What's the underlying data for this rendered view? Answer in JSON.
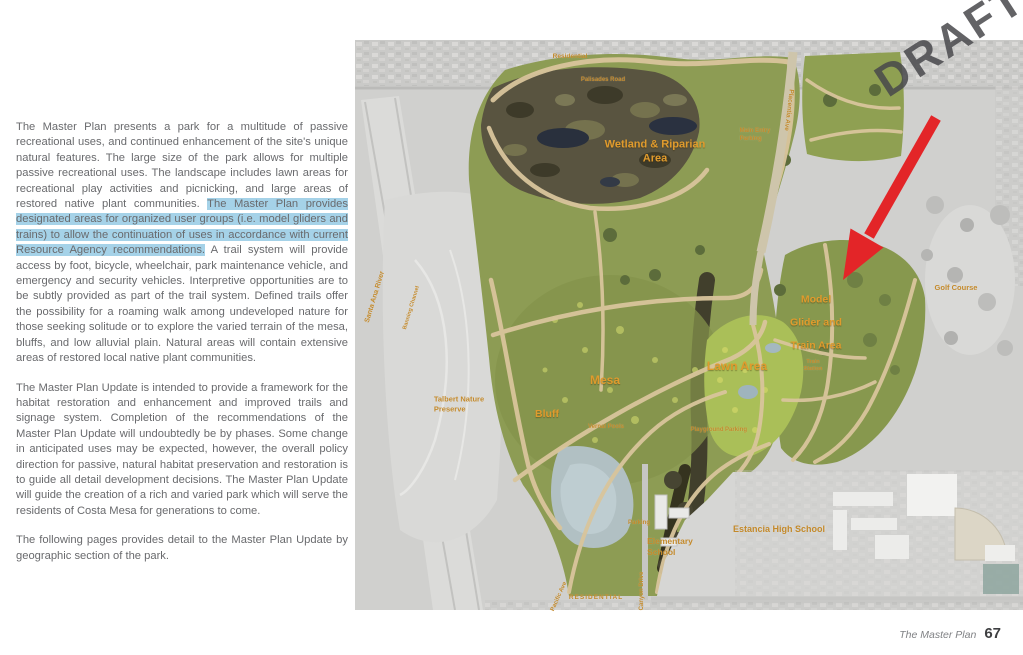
{
  "watermark": "DRAFT",
  "footer": {
    "section": "The Master Plan",
    "page": "67"
  },
  "article": {
    "p1_before": "The Master Plan presents a park for a multitude of passive recreational uses, and continued enhancement of the site's unique natural features. The large size of the park allows for multiple passive recreational uses. The landscape includes lawn areas for recreational play activities and picnicking, and large areas of restored native plant communities. ",
    "p1_highlight": "The Master Plan provides designated areas for organized user groups (i.e. model gliders and trains) to allow the continuation of uses in accordance with current Resource Agency recommendations.",
    "p1_after": " A trail system will provide access by foot, bicycle, wheelchair, park maintenance vehicle, and emergency and security vehicles. Interpretive opportunities are to be subtly provided as part of the trail system. Defined trails offer the possibility for a roaming walk among undeveloped nature for those seeking solitude or to explore the varied terrain of the mesa, bluffs, and low alluvial plain. Natural areas will contain extensive areas of restored local native plant communities.",
    "p2": "The Master Plan Update is intended to provide a framework for the habitat restoration and enhancement and improved trails and signage system. Completion of the recommendations of the Master Plan Update will undoubtedly be by phases. Some change in anticipated uses may be expected, however, the overall policy direction for passive, natural habitat preservation and restoration is to guide all detail development decisions. The Master Plan Update will guide the creation of a rich and varied park which will serve the residents of Costa Mesa for generations to come.",
    "p3": "The following pages provides detail to the Master Plan Update by geographic section of the park."
  },
  "map": {
    "colors": {
      "label_orange": "#e09b2d",
      "label_gold": "#c3892a",
      "highlight_blue": "#a5d2e8",
      "arrow_red": "#e32528",
      "park_green": "#8d9c54",
      "wetland_dark": "#595440"
    },
    "labels": [
      {
        "id": "residential-north",
        "text": "Residential",
        "x": 215,
        "y": 17,
        "size": 6.5,
        "rot": 0,
        "cls": "gold"
      },
      {
        "id": "palisades-road",
        "text": "Palisades Road",
        "x": 248,
        "y": 41,
        "size": 6,
        "rot": 0,
        "cls": "gold"
      },
      {
        "id": "placentia-ave",
        "text": "Placentia Ave",
        "x": 433,
        "y": 70,
        "size": 6.5,
        "rot": 97,
        "cls": "gold"
      },
      {
        "id": "main-entry-parking",
        "text": "Main Entry\nParking",
        "x": 400,
        "y": 96,
        "size": 6,
        "rot": 0,
        "cls": "gold",
        "align": "left"
      },
      {
        "id": "wetland-riparian-area",
        "text": "Wetland & Riparian\nArea",
        "x": 300,
        "y": 112,
        "size": 11,
        "rot": 0,
        "cls": "orange",
        "weight": 700
      },
      {
        "id": "santa-ana-river",
        "text": "Santa Ana River",
        "x": 20,
        "y": 257,
        "size": 7,
        "rot": -73,
        "cls": "gold",
        "weight": 700
      },
      {
        "id": "banning-channel",
        "text": "Banning Channel",
        "x": 57,
        "y": 268,
        "size": 5.5,
        "rot": -73,
        "cls": "gold"
      },
      {
        "id": "golf-course",
        "text": "Golf Course",
        "x": 601,
        "y": 248,
        "size": 7.5,
        "rot": 0,
        "cls": "gold",
        "weight": 700
      },
      {
        "id": "talbert-nature-preserve",
        "text": "Talbert Nature\nPreserve",
        "x": 104,
        "y": 364,
        "size": 7.5,
        "rot": 0,
        "cls": "gold",
        "weight": 700,
        "align": "left"
      },
      {
        "id": "bluff",
        "text": "Bluff",
        "x": 192,
        "y": 375,
        "size": 10.5,
        "rot": 0,
        "cls": "orange",
        "weight": 700
      },
      {
        "id": "mesa",
        "text": "Mesa",
        "x": 250,
        "y": 341,
        "size": 12,
        "rot": 0,
        "cls": "orange",
        "weight": 700
      },
      {
        "id": "lawn-area",
        "text": "Lawn Area",
        "x": 382,
        "y": 327,
        "size": 12,
        "rot": 0,
        "cls": "orange",
        "weight": 700
      },
      {
        "id": "vernal-pools",
        "text": "Vernal Pools",
        "x": 251,
        "y": 388,
        "size": 6,
        "rot": 0,
        "cls": "gold",
        "weight": 700
      },
      {
        "id": "playground",
        "text": "Playground",
        "x": 352,
        "y": 391,
        "size": 6,
        "rot": 0,
        "cls": "gold"
      },
      {
        "id": "parking-lawn",
        "text": "Parking",
        "x": 381,
        "y": 391,
        "size": 6,
        "rot": 0,
        "cls": "gold"
      },
      {
        "id": "model-glider-train-area",
        "text": "Model\nGlider and\nTrain Area",
        "x": 461,
        "y": 283,
        "size": 10.5,
        "rot": 0,
        "cls": "orange",
        "weight": 700,
        "lh": 2.2
      },
      {
        "id": "train-station",
        "text": "Train\nStation",
        "x": 458,
        "y": 326,
        "size": 5.5,
        "rot": 0,
        "cls": "gold"
      },
      {
        "id": "parking-south",
        "text": "Parking",
        "x": 284,
        "y": 484,
        "size": 6,
        "rot": 0,
        "cls": "gold"
      },
      {
        "id": "elementary-school",
        "text": "Elementary\nSchool",
        "x": 315,
        "y": 507,
        "size": 8.5,
        "rot": 0,
        "cls": "gold",
        "weight": 700,
        "align": "left"
      },
      {
        "id": "estancia-high-school",
        "text": "Estancia High School",
        "x": 424,
        "y": 490,
        "size": 9,
        "rot": 0,
        "cls": "gold",
        "weight": 700
      },
      {
        "id": "canyon-drive",
        "text": "Canyon Drive",
        "x": 288,
        "y": 551,
        "size": 6,
        "rot": -90,
        "cls": "gold"
      },
      {
        "id": "pacific-ave",
        "text": "Pacific Ave",
        "x": 205,
        "y": 557,
        "size": 6,
        "rot": -66,
        "cls": "gold"
      },
      {
        "id": "residential-south",
        "text": "RESIDENTIAL",
        "x": 241,
        "y": 558,
        "size": 6.5,
        "rot": 0,
        "cls": "gold",
        "weight": 700,
        "ls": 1
      }
    ]
  }
}
